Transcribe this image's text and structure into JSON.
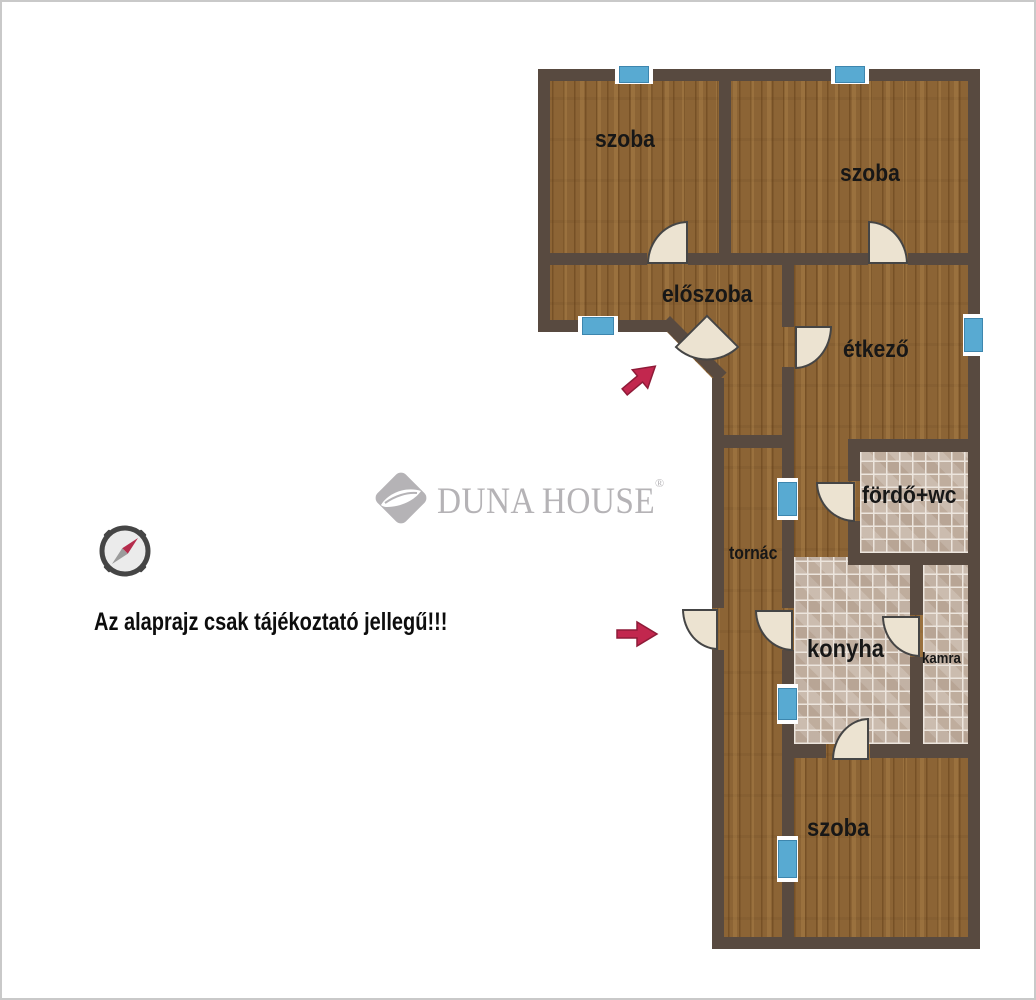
{
  "branding": {
    "logo_text": "DUNA HOUSE",
    "registered_mark": "®"
  },
  "disclaimer": {
    "text": "Az alaprajz csak tájékoztató jellegű!!!"
  },
  "colors": {
    "wall": "#584a40",
    "wood": "#8c6435",
    "tile_base": "#cdbfb3",
    "window_blue": "#58aad2",
    "window_border": "#3d86ae",
    "door_fill": "#ece3d1",
    "door_border": "#454545",
    "arrow_fill": "#c2274e",
    "arrow_stroke": "#8e1b38",
    "label": "#171717",
    "logo_gray": "#b5b3b6",
    "frame": "#c9c9c9"
  },
  "floorplan": {
    "outline": "536,67 978,67 978,947 710,947 710,376 665,330 536,330",
    "tile_areas": [
      {
        "name": "bathroom-floor",
        "x": 858,
        "y": 450,
        "w": 108,
        "h": 101
      },
      {
        "name": "kitchen-floor",
        "x": 792,
        "y": 555,
        "w": 116,
        "h": 187
      },
      {
        "name": "pantry-floor",
        "x": 921,
        "y": 563,
        "w": 45,
        "h": 179
      }
    ],
    "walls": [
      {
        "x": 536,
        "y": 67,
        "w": 442,
        "h": 12
      },
      {
        "x": 536,
        "y": 67,
        "w": 12,
        "h": 263
      },
      {
        "x": 966,
        "y": 67,
        "w": 12,
        "h": 880
      },
      {
        "x": 710,
        "y": 935,
        "w": 268,
        "h": 12
      },
      {
        "x": 710,
        "y": 376,
        "w": 12,
        "h": 230
      },
      {
        "x": 710,
        "y": 648,
        "w": 12,
        "h": 299
      },
      {
        "x": 536,
        "y": 318,
        "w": 129,
        "h": 12
      },
      {
        "x": 717,
        "y": 79,
        "w": 12,
        "h": 172
      },
      {
        "x": 548,
        "y": 251,
        "w": 97,
        "h": 12
      },
      {
        "x": 686,
        "y": 251,
        "w": 180,
        "h": 12
      },
      {
        "x": 906,
        "y": 251,
        "w": 60,
        "h": 12
      },
      {
        "x": 780,
        "y": 263,
        "w": 12,
        "h": 62
      },
      {
        "x": 780,
        "y": 365,
        "w": 12,
        "h": 241
      },
      {
        "x": 780,
        "y": 648,
        "w": 12,
        "h": 287
      },
      {
        "x": 722,
        "y": 433,
        "w": 70,
        "h": 13
      },
      {
        "x": 846,
        "y": 437,
        "w": 120,
        "h": 13
      },
      {
        "x": 846,
        "y": 450,
        "w": 12,
        "h": 29
      },
      {
        "x": 846,
        "y": 519,
        "w": 12,
        "h": 44
      },
      {
        "x": 846,
        "y": 551,
        "w": 120,
        "h": 12
      },
      {
        "x": 908,
        "y": 563,
        "w": 13,
        "h": 50
      },
      {
        "x": 908,
        "y": 655,
        "w": 13,
        "h": 87
      },
      {
        "x": 792,
        "y": 742,
        "w": 32,
        "h": 14
      },
      {
        "x": 868,
        "y": 742,
        "w": 98,
        "h": 14
      },
      {
        "x": 668,
        "y": 314,
        "w": 80,
        "h": 13,
        "rot": 45
      }
    ],
    "windows": [
      {
        "x": 613,
        "y": 63,
        "w": 38,
        "h": 19,
        "dir": "h"
      },
      {
        "x": 829,
        "y": 63,
        "w": 38,
        "h": 19,
        "dir": "h"
      },
      {
        "x": 576,
        "y": 314,
        "w": 40,
        "h": 20,
        "dir": "h"
      },
      {
        "x": 961,
        "y": 312,
        "w": 21,
        "h": 42,
        "dir": "v"
      },
      {
        "x": 775,
        "y": 476,
        "w": 21,
        "h": 42,
        "dir": "v"
      },
      {
        "x": 775,
        "y": 682,
        "w": 21,
        "h": 40,
        "dir": "v"
      },
      {
        "x": 775,
        "y": 834,
        "w": 21,
        "h": 46,
        "dir": "v"
      }
    ],
    "doors": [
      {
        "x": 645,
        "y": 219,
        "w": 41,
        "h": 43,
        "corner": "br"
      },
      {
        "x": 866,
        "y": 219,
        "w": 40,
        "h": 43,
        "corner": "bl"
      },
      {
        "x": 682,
        "y": 322,
        "w": 46,
        "h": 46,
        "corner": "tl",
        "rot": 45
      },
      {
        "x": 793,
        "y": 324,
        "w": 37,
        "h": 43,
        "corner": "tl"
      },
      {
        "x": 814,
        "y": 480,
        "w": 39,
        "h": 40,
        "corner": "tr"
      },
      {
        "x": 680,
        "y": 607,
        "w": 36,
        "h": 41,
        "corner": "tr"
      },
      {
        "x": 753,
        "y": 608,
        "w": 38,
        "h": 41,
        "corner": "tr"
      },
      {
        "x": 880,
        "y": 614,
        "w": 38,
        "h": 41,
        "corner": "tr"
      },
      {
        "x": 830,
        "y": 716,
        "w": 37,
        "h": 42,
        "corner": "br"
      }
    ],
    "arrows": [
      {
        "x": 616,
        "y": 362,
        "w": 44,
        "h": 30,
        "rot": -40
      },
      {
        "x": 613,
        "y": 617,
        "w": 44,
        "h": 30,
        "rot": 0
      }
    ],
    "rooms": [
      {
        "id": "room-top-left",
        "label": "szoba",
        "x": 593,
        "y": 124,
        "size": 24
      },
      {
        "id": "room-top-right",
        "label": "szoba",
        "x": 838,
        "y": 158,
        "size": 24
      },
      {
        "id": "hallway",
        "label": "előszoba",
        "x": 660,
        "y": 279,
        "size": 24
      },
      {
        "id": "dining",
        "label": "étkező",
        "x": 841,
        "y": 334,
        "size": 24
      },
      {
        "id": "bathroom",
        "label": "fördő+wc",
        "x": 860,
        "y": 480,
        "size": 24
      },
      {
        "id": "porch",
        "label": "tornác",
        "x": 727,
        "y": 541,
        "size": 18
      },
      {
        "id": "kitchen",
        "label": "konyha",
        "x": 805,
        "y": 633,
        "size": 25
      },
      {
        "id": "pantry",
        "label": "kamra",
        "x": 920,
        "y": 648,
        "size": 15
      },
      {
        "id": "room-bottom",
        "label": "szoba",
        "x": 805,
        "y": 812,
        "size": 25
      }
    ]
  },
  "compass": {
    "cx": 123,
    "cy": 549,
    "r": 26
  }
}
